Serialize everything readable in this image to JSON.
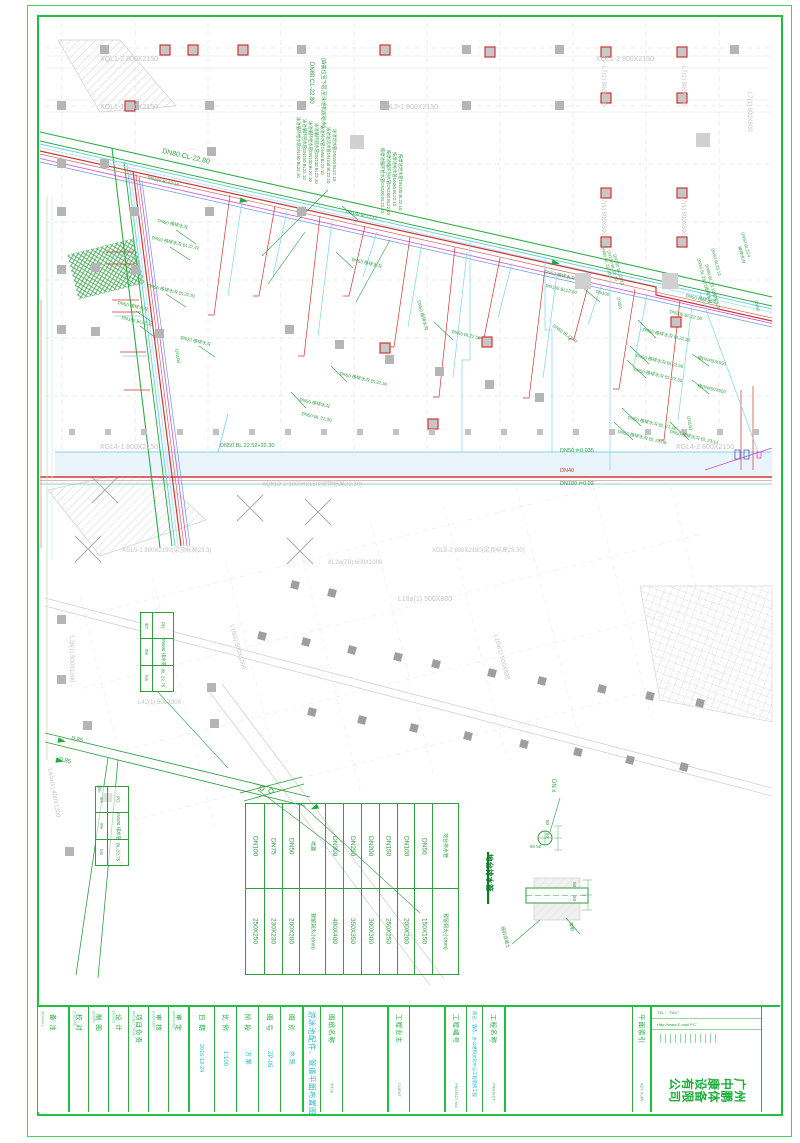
{
  "page": {
    "frame_color": "#1fbf3f",
    "accent_green": "#2f9e41",
    "accent_cyan": "#25b9cc",
    "pipe_red": "#d23535",
    "pipe_magenta": "#cf4fd0"
  },
  "plan": {
    "labels": [
      {
        "t": "XQL1-2 800X2150",
        "x": 100,
        "y": 56,
        "c": "y",
        "fs": 7
      },
      {
        "t": "XQL1-2 800X2150",
        "x": 596,
        "y": 56,
        "c": "y",
        "fs": 7
      },
      {
        "t": "XQL1-1 800X2150",
        "x": 100,
        "y": 104,
        "c": "y",
        "fs": 7
      },
      {
        "t": "XQL2-1 800X2150",
        "x": 380,
        "y": 104,
        "c": "y",
        "fs": 7
      },
      {
        "t": "L7(1) 800X600",
        "x": 606,
        "y": 66,
        "r": 90,
        "c": "y",
        "fs": 6
      },
      {
        "t": "L7(1) 800X600",
        "x": 686,
        "y": 66,
        "r": 90,
        "c": "y",
        "fs": 6
      },
      {
        "t": "L7(1) 800X600",
        "x": 606,
        "y": 196,
        "r": 90,
        "c": "y",
        "fs": 6
      },
      {
        "t": "L7(1) 800X600",
        "x": 686,
        "y": 196,
        "r": 90,
        "c": "y",
        "fs": 6
      },
      {
        "t": "L7(1) 800X600",
        "x": 752,
        "y": 92,
        "r": 90,
        "c": "y",
        "fs": 6
      },
      {
        "t": "XGL4-1 800X2150",
        "x": 100,
        "y": 444,
        "c": "y",
        "fs": 7
      },
      {
        "t": "XGL4-2 800X2150",
        "x": 676,
        "y": 444,
        "c": "y",
        "fs": 7
      },
      {
        "t": "XQKL2-2 1000X2150(梁顶标高23.30)",
        "x": 262,
        "y": 482,
        "c": "y",
        "fs": 6
      },
      {
        "t": "XGL5-1 800X2150(梁顶标高23.3)",
        "x": 122,
        "y": 548,
        "c": "y",
        "fs": 6
      },
      {
        "t": "XGL5-2 800X2150(梁顶标高23.30)",
        "x": 432,
        "y": 548,
        "c": "y",
        "fs": 6
      },
      {
        "t": "KL2a(7B) 600X1000",
        "x": 328,
        "y": 560,
        "c": "y",
        "fs": 6
      },
      {
        "t": "L18a(1) 500X800",
        "x": 398,
        "y": 596,
        "c": "y",
        "fs": 7
      },
      {
        "t": "L18(1) 500X1000",
        "x": 74,
        "y": 636,
        "r": 90,
        "c": "y",
        "fs": 6
      },
      {
        "t": "L18(1) 500X1000",
        "x": 234,
        "y": 624,
        "r": 75,
        "c": "y",
        "fs": 6
      },
      {
        "t": "L42(1) 500X800",
        "x": 138,
        "y": 700,
        "c": "y",
        "fs": 6
      },
      {
        "t": "L18a(1) 500X800",
        "x": 498,
        "y": 634,
        "r": 75,
        "c": "y",
        "fs": 6
      },
      {
        "t": "L44a(1) 400X1300",
        "x": 52,
        "y": 768,
        "r": 80,
        "c": "y",
        "fs": 6
      },
      {
        "t": "400X1300(梁)",
        "x": 118,
        "y": 836,
        "r": 80,
        "c": "y",
        "fs": 5
      },
      {
        "t": "DN80 CL-22.80",
        "x": 163,
        "y": 148,
        "r": 13,
        "c": "g",
        "fs": 7
      },
      {
        "t": "DN80 CL-22.80",
        "x": 314,
        "y": 62,
        "r": 90,
        "c": "g",
        "fs": 6
      },
      {
        "t": "(由高位至下层,至泳池机房给水)",
        "x": 325,
        "y": 58,
        "r": 90,
        "c": "g",
        "fs": 5
      },
      {
        "t": "DN150 BL22.12",
        "x": 148,
        "y": 176,
        "r": 13,
        "c": "g",
        "fs": 4.5
      },
      {
        "t": "DN50 接排水沟",
        "x": 158,
        "y": 219,
        "r": 13,
        "c": "g",
        "fs": 4.5
      },
      {
        "t": "DN50 接排水沟 BL22.42",
        "x": 152,
        "y": 236,
        "r": 13,
        "c": "g",
        "fs": 4.5
      },
      {
        "t": "DN50 接排水沟 BL22.92",
        "x": 148,
        "y": 284,
        "r": 13,
        "c": "g",
        "fs": 4.5
      },
      {
        "t": "DN50 接排水沟",
        "x": 118,
        "y": 301,
        "r": 13,
        "c": "g",
        "fs": 4.5
      },
      {
        "t": "DN150 BL22.30",
        "x": 122,
        "y": 316,
        "r": 13,
        "c": "g",
        "fs": 4.5
      },
      {
        "t": "DN32 接排水沟",
        "x": 181,
        "y": 336,
        "r": 13,
        "c": "g",
        "fs": 4.5
      },
      {
        "t": "DN100",
        "x": 178,
        "y": 349,
        "r": 80,
        "c": "g",
        "fs": 4.5
      },
      {
        "t": "DN150 BL22.12",
        "x": 346,
        "y": 210,
        "r": 13,
        "c": "g",
        "fs": 4.5
      },
      {
        "t": "DN50 接排水沟",
        "x": 352,
        "y": 258,
        "r": 13,
        "c": "g",
        "fs": 4.5
      },
      {
        "t": "DN50 接排水沟",
        "x": 420,
        "y": 300,
        "r": 75,
        "c": "g",
        "fs": 4.5
      },
      {
        "t": "DN50 BL22.50",
        "x": 452,
        "y": 330,
        "r": 13,
        "c": "g",
        "fs": 4.5
      },
      {
        "t": "DN50 接排水沟 BL22.50",
        "x": 340,
        "y": 372,
        "r": 13,
        "c": "g",
        "fs": 4.5
      },
      {
        "t": "DN50 接排水沟",
        "x": 300,
        "y": 398,
        "r": 13,
        "c": "g",
        "fs": 4.5
      },
      {
        "t": "DN50 BL 22.30",
        "x": 302,
        "y": 412,
        "r": 13,
        "c": "g",
        "fs": 4.5
      },
      {
        "t": "DN50 接排水沟",
        "x": 545,
        "y": 270,
        "r": 13,
        "c": "g",
        "fs": 4.5
      },
      {
        "t": "DN150 BL22.50",
        "x": 546,
        "y": 284,
        "r": 13,
        "c": "g",
        "fs": 4.5
      },
      {
        "t": "DN100",
        "x": 596,
        "y": 290,
        "r": 13,
        "c": "g",
        "fs": 4.5
      },
      {
        "t": "DN50",
        "x": 620,
        "y": 297,
        "r": 80,
        "c": "g",
        "fs": 4.5
      },
      {
        "t": "DN80 BL 22.10",
        "x": 604,
        "y": 246,
        "r": 75,
        "c": "g",
        "fs": 4.3
      },
      {
        "t": "DN150 BL 22.10",
        "x": 610,
        "y": 250,
        "r": 75,
        "c": "g",
        "fs": 4.3
      },
      {
        "t": "DN100 BL 22.12",
        "x": 616,
        "y": 254,
        "r": 75,
        "c": "g",
        "fs": 4.3
      },
      {
        "t": "DN50 BL23.12",
        "x": 714,
        "y": 248,
        "r": 75,
        "c": "g",
        "fs": 4.3
      },
      {
        "t": "DN50 BL 23.12接排水沟",
        "x": 700,
        "y": 258,
        "r": 75,
        "c": "g",
        "fs": 4.3
      },
      {
        "t": "DN80 BL 23.12接排水沟",
        "x": 708,
        "y": 264,
        "r": 75,
        "c": "g",
        "fs": 4.3
      },
      {
        "t": "DN50 BL23.4",
        "x": 744,
        "y": 232,
        "r": 75,
        "c": "g",
        "fs": 4.3
      },
      {
        "t": "接排水沟",
        "x": 741,
        "y": 246,
        "r": 75,
        "c": "g",
        "fs": 4.3
      },
      {
        "t": "DN50",
        "x": 757,
        "y": 300,
        "r": 75,
        "c": "g",
        "fs": 4.3
      },
      {
        "t": "DN50 接排水沟",
        "x": 686,
        "y": 294,
        "r": 13,
        "c": "g",
        "fs": 4.5
      },
      {
        "t": "DN200 BL 22.50",
        "x": 670,
        "y": 310,
        "r": 13,
        "c": "g",
        "fs": 4.5
      },
      {
        "t": "DN50 BL22.42",
        "x": 554,
        "y": 324,
        "r": 35,
        "c": "g",
        "fs": 4.5
      },
      {
        "t": "DN50 接排水沟 BL22.50",
        "x": 643,
        "y": 328,
        "r": 13,
        "c": "g",
        "fs": 4.5
      },
      {
        "t": "DN50 接排水沟 BL22.58",
        "x": 636,
        "y": 354,
        "r": 13,
        "c": "g",
        "fs": 4.5
      },
      {
        "t": "DN50 接排水沟 BL 22.35",
        "x": 634,
        "y": 368,
        "r": 13,
        "c": "g",
        "fs": 4.5
      },
      {
        "t": "DN50 接排水沟 BL 22.40",
        "x": 628,
        "y": 416,
        "r": 13,
        "c": "g",
        "fs": 4.5
      },
      {
        "t": "DN50 接排水沟 BL 23.08",
        "x": 618,
        "y": 430,
        "r": 13,
        "c": "g",
        "fs": 4.5
      },
      {
        "t": "DN100",
        "x": 690,
        "y": 416,
        "r": 80,
        "c": "g",
        "fs": 4.5
      },
      {
        "t": "DN50 接排水沟 BL 23.12",
        "x": 670,
        "y": 430,
        "r": 13,
        "c": "g",
        "fs": 4.5
      },
      {
        "t": "接DN450X650",
        "x": 698,
        "y": 356,
        "r": 13,
        "c": "g",
        "fs": 4.5
      },
      {
        "t": "接DN450X650",
        "x": 698,
        "y": 384,
        "r": 13,
        "c": "g",
        "fs": 4.5
      },
      {
        "t": "DN50 BL 22.52+22.30",
        "x": 220,
        "y": 444,
        "c": "g",
        "fs": 5.5
      },
      {
        "t": "DN50 i=0.035",
        "x": 560,
        "y": 449,
        "c": "g",
        "fs": 5.5
      },
      {
        "t": "DN40",
        "x": 560,
        "y": 469,
        "c": "r",
        "fs": 5.5
      },
      {
        "t": "DN100 i=0.02",
        "x": 560,
        "y": 482,
        "c": "g",
        "fs": 5.5
      },
      {
        "t": "泳池循环给水管DN150 BL22.10",
        "x": 300,
        "y": 117,
        "r": 90,
        "c": "g",
        "fs": 4.3
      },
      {
        "t": "泳池循环回水管DN150 BL22.10",
        "x": 306,
        "y": 119,
        "r": 90,
        "c": "g",
        "fs": 4.3
      },
      {
        "t": "泳池循环给水管DN100 BL22.10",
        "x": 312,
        "y": 121,
        "r": 90,
        "c": "g",
        "fs": 4.3
      },
      {
        "t": "泳池循环回水管DN100 BL22.10",
        "x": 318,
        "y": 123,
        "r": 90,
        "c": "g",
        "fs": 4.3
      },
      {
        "t": "泳池补水管DN50 BL22.10",
        "x": 324,
        "y": 125,
        "r": 90,
        "c": "g",
        "fs": 4.3
      },
      {
        "t": "泳池溢流水管DN100 BL22.10",
        "x": 330,
        "y": 127,
        "r": 90,
        "c": "g",
        "fs": 4.3
      },
      {
        "t": "泳池泄水管DN150 BL22.10",
        "x": 336,
        "y": 129,
        "r": 90,
        "c": "g",
        "fs": 4.3
      },
      {
        "t": "按摩池循环给水管DN100 BL22.10",
        "x": 384,
        "y": 148,
        "r": 90,
        "c": "g",
        "fs": 4.3
      },
      {
        "t": "按摩池循环回水管DN100 BL22.10",
        "x": 390,
        "y": 150,
        "r": 90,
        "c": "g",
        "fs": 4.3
      },
      {
        "t": "按摩池补水管DN50 BL22.10",
        "x": 396,
        "y": 152,
        "r": 90,
        "c": "g",
        "fs": 4.3
      },
      {
        "t": "按摩池泄水管DN100 BL22.10",
        "x": 402,
        "y": 154,
        "r": 90,
        "c": "g",
        "fs": 4.3
      },
      {
        "t": "地台排水管",
        "x": 493,
        "y": 854,
        "r": 90,
        "c": "G",
        "fs": 7.5,
        "w": 700
      },
      {
        "t": "DN x",
        "x": 556,
        "y": 779,
        "r": 90,
        "c": "g",
        "fs": 6
      },
      {
        "t": "50",
        "x": 549,
        "y": 820,
        "r": 90,
        "c": "g",
        "fs": 4.5
      },
      {
        "t": "50",
        "x": 549,
        "y": 833,
        "r": 90,
        "c": "g",
        "fs": 4.5
      },
      {
        "t": "50 50",
        "x": 530,
        "y": 845,
        "c": "g",
        "fs": 4.5
      },
      {
        "t": "50",
        "x": 576,
        "y": 882,
        "r": 90,
        "c": "g",
        "fs": 4.5
      },
      {
        "t": "50",
        "x": 576,
        "y": 896,
        "r": 90,
        "c": "g",
        "fs": 4.5
      },
      {
        "t": "细石混凝土",
        "x": 504,
        "y": 926,
        "r": 75,
        "c": "g",
        "fs": 4.5
      },
      {
        "t": "楼板",
        "x": 572,
        "y": 922,
        "r": 75,
        "c": "g",
        "fs": 4.5
      },
      {
        "t": "0.85",
        "x": 72,
        "y": 736,
        "r": 12,
        "c": "g",
        "fs": 6
      },
      {
        "t": "0.85",
        "x": 60,
        "y": 757,
        "r": 12,
        "c": "g",
        "fs": 6
      }
    ]
  },
  "hole_table": {
    "cols": [
      {
        "top": "DN100",
        "bot": "250X250"
      },
      {
        "top": "DN75",
        "bot": "230X230"
      },
      {
        "top": "DN50",
        "bot": "200X200"
      },
      {
        "top": "地漏",
        "bot": "预留洞大小(mm)"
      },
      {
        "top": "DN300",
        "bot": "400X400"
      },
      {
        "top": "DN250",
        "bot": "350X350"
      },
      {
        "top": "DN200",
        "bot": "300X300"
      },
      {
        "top": "DN150",
        "bot": "250X250"
      },
      {
        "top": "DN100",
        "bot": "200X200"
      },
      {
        "top": "DN50",
        "bot": "150X150"
      },
      {
        "top": "地台排水管",
        "bot": "预留洞大小(mm)"
      }
    ]
  },
  "pd_tag": {
    "row_labels": [
      "编号",
      "管径",
      "标高"
    ],
    "values": [
      "PD",
      "DN100 排水管",
      "BL 22.75"
    ]
  },
  "title_block": {
    "remarks": {
      "label": "备 注",
      "sub": "REMARKS"
    },
    "sign_cells": [
      {
        "label": "校 对",
        "sub": "CHECKED"
      },
      {
        "label": "制 图",
        "sub": "DRAWN"
      },
      {
        "label": "设 计",
        "sub": "DESIGN"
      },
      {
        "label": "项目负责",
        "sub": "PROJECT CHIEF"
      },
      {
        "label": "审 核",
        "sub": "EXAMINED"
      },
      {
        "label": "审 定",
        "sub": "APPROVED"
      }
    ],
    "meta_cells": [
      {
        "label": "日 期",
        "value": "2015-12-24"
      },
      {
        "label": "比 例",
        "value": "1:100"
      },
      {
        "label": "阶 段",
        "value": "方 案"
      },
      {
        "label": "图 号",
        "value": "ZP-05"
      },
      {
        "label": "图 别",
        "value": "水 施"
      }
    ],
    "drawing_title": "游泳池配件、管道平面布置图",
    "title_label": "图纸名称",
    "title_sub": "TITLE",
    "client_label": "工程业主",
    "client_sub": "CLIENT",
    "project_no_label": "工程编号",
    "project_no_sub": "PROJECT NO.",
    "project_desc": "商业、酒店、办公楼和文化中心工程装修工程",
    "project_label": "工程名称",
    "project_sub": "PROJECT",
    "key_plan_label": "平面索引",
    "key_plan_sub": "KEY PLAN",
    "company": "广州中鹏康体设备有限公司",
    "contact_line1": "TEL：      FAX：",
    "contact_line2": "Http://www      E-mail      P.C："
  }
}
